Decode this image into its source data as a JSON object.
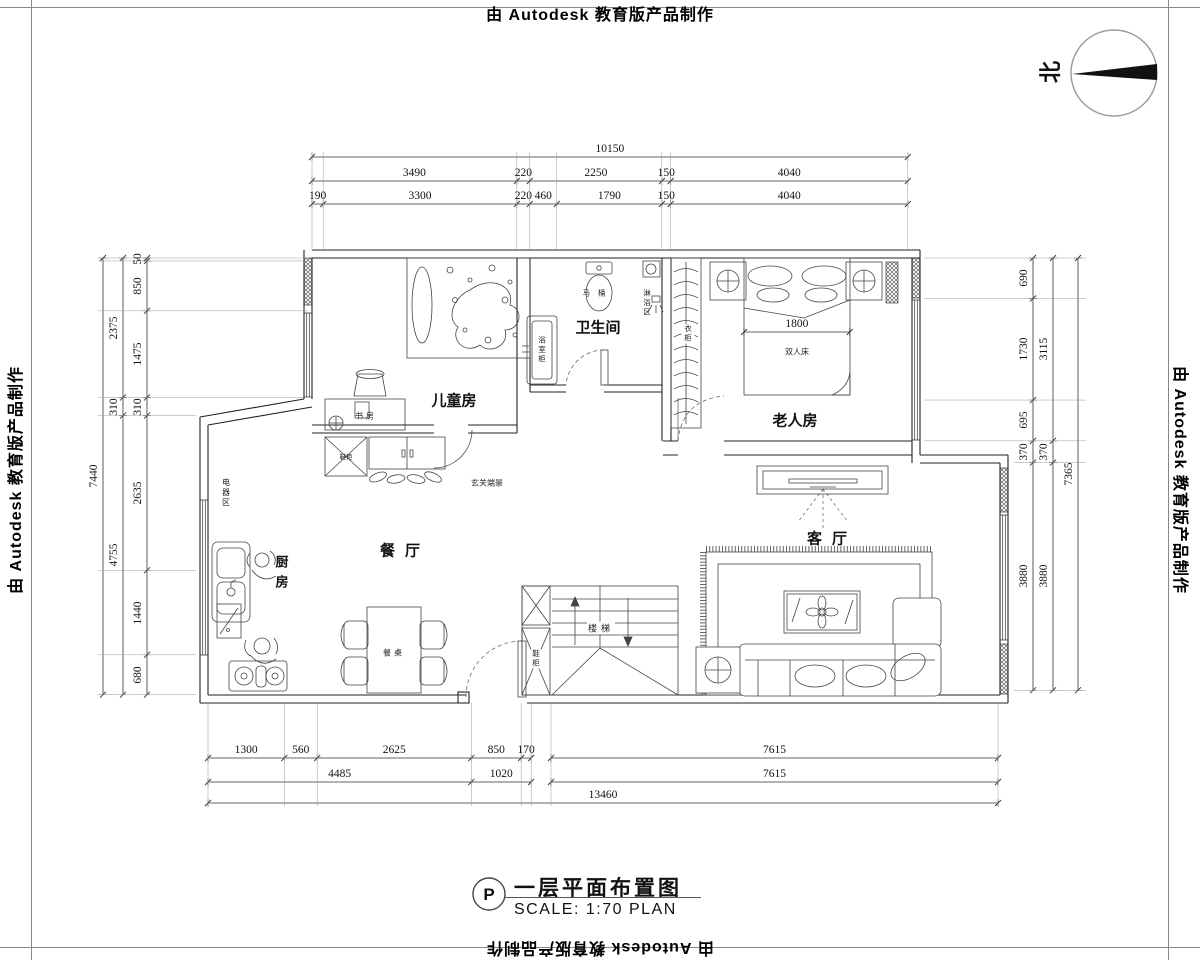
{
  "watermark": {
    "text": "由 Autodesk 教育版产品制作"
  },
  "north": {
    "label": "北"
  },
  "title_block": {
    "tag": "P",
    "title": "一层平面布置图",
    "scale": "SCALE: 1:70 PLAN"
  },
  "rooms": {
    "children": "儿童房",
    "bathroom": "卫生间",
    "elder": "老人房",
    "dining": "餐厅",
    "kitchen": "厨房",
    "living": "客厅",
    "stairs": "楼梯",
    "study": "书房",
    "entry_view": "玄关端景",
    "appliance_zone": "电器区"
  },
  "fixtures": {
    "toilet": "马桶",
    "shower_zone": "淋浴区",
    "vanity": "浴室柜",
    "wardrobe": "衣柜",
    "shoe_cabinet_entry": "鞋柜",
    "shoe_cabinet_stairs": "鞋柜",
    "dining_table": "餐桌",
    "double_bed": "双人床"
  },
  "dimensions": {
    "top_row1": [
      "10150"
    ],
    "top_row2": [
      "3490",
      "220",
      "2250",
      "150",
      "4040"
    ],
    "top_row3": [
      "190",
      "3300",
      "220",
      "460",
      "1790",
      "150",
      "4040"
    ],
    "left_outer": [
      "7440"
    ],
    "left_mid": [
      "2375",
      "310",
      "4755"
    ],
    "left_inner": [
      "50",
      "850",
      "1475",
      "310",
      "2635",
      "1440",
      "680"
    ],
    "right_inner": [
      "690",
      "1730",
      "695",
      "370",
      "3880"
    ],
    "right_mid": [
      "3115",
      "370",
      "3880"
    ],
    "right_outer": [
      "7365"
    ],
    "bottom_row1_left": [
      "1300",
      "560",
      "2625",
      "850",
      "170"
    ],
    "bottom_row1_right": [
      "7615"
    ],
    "bottom_row2_left": [
      "4485",
      "1020"
    ],
    "bottom_row2_right": [
      "7615"
    ],
    "bottom_row3": [
      "13460"
    ],
    "bed_width": [
      "1800"
    ]
  }
}
